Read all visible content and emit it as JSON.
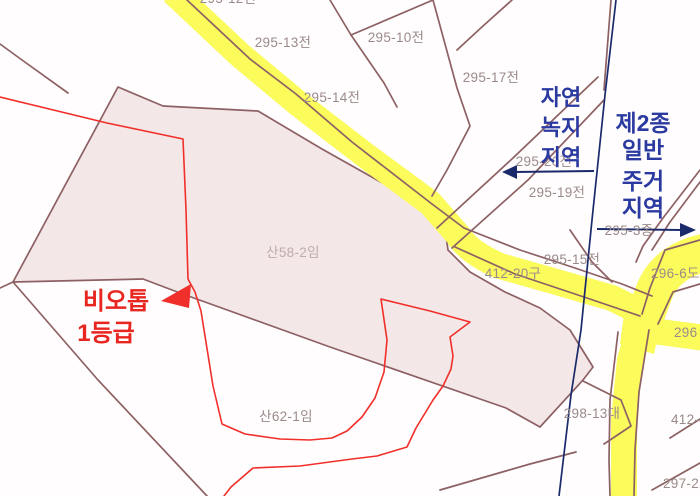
{
  "map": {
    "title": "cadastral zoning map",
    "parcel_labels": [
      {
        "id": 0,
        "text": "295-13전"
      },
      {
        "id": 1,
        "text": "295-10전"
      },
      {
        "id": 2,
        "text": "295-14전"
      },
      {
        "id": 3,
        "text": "295-17전"
      },
      {
        "id": 4,
        "text": "295-20전"
      },
      {
        "id": 5,
        "text": "295-19전"
      },
      {
        "id": 6,
        "text": "295-3종"
      },
      {
        "id": 7,
        "text": "295-15전"
      },
      {
        "id": 8,
        "text": "412-20구"
      },
      {
        "id": 9,
        "text": "296-6도"
      },
      {
        "id": 10,
        "text": "296"
      },
      {
        "id": 11,
        "text": "298-13대"
      },
      {
        "id": 12,
        "text": "412-4"
      },
      {
        "id": 13,
        "text": "297-2"
      },
      {
        "id": 14,
        "text": "산58-2임"
      },
      {
        "id": 15,
        "text": "산62-1임"
      },
      {
        "id": 16,
        "text": "295-12전"
      }
    ],
    "zoning_labels": {
      "nature_green": {
        "lines": [
          "자연",
          "녹지",
          "지역"
        ]
      },
      "residential": {
        "lines": [
          "제2종",
          "일반",
          "주거",
          "지역"
        ]
      }
    },
    "annotation": {
      "biotope": {
        "lines": [
          "비오톱",
          "1등급"
        ]
      }
    },
    "colors": {
      "background": "#ffffff",
      "parcel_line": "#8d6164",
      "biotope_area_fill": "#f4e7e7",
      "road_yellow": "#fbfb5b",
      "zoning_text_blue": "#2b3aa0",
      "boundary_line_blue": "#1b2a6b",
      "biotope_red": "#f12f2a",
      "parcel_label_gray": "#9b8a8a",
      "parcel_label_pink": "#c0abab"
    }
  }
}
